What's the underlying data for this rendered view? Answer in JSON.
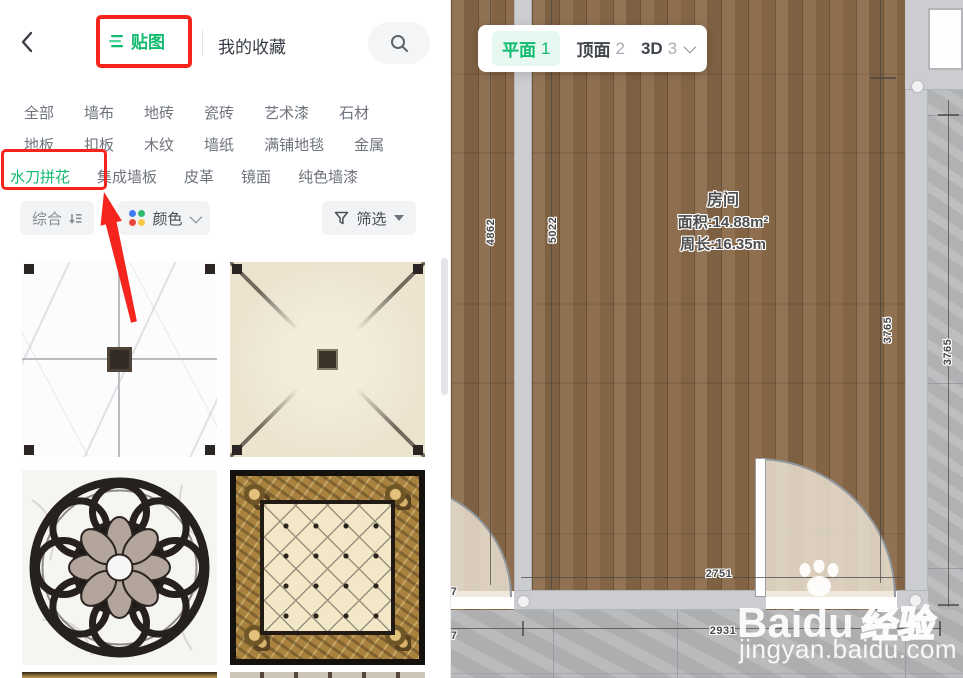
{
  "sidebar": {
    "tabs": {
      "textures": "贴图",
      "favorites": "我的收藏"
    },
    "categories_row1": [
      "全部",
      "墙布",
      "地砖",
      "瓷砖",
      "艺术漆",
      "石材"
    ],
    "categories_row2": [
      "地板",
      "扣板",
      "木纹",
      "墙纸",
      "满铺地毯",
      "金属"
    ],
    "categories_row3": [
      "水刀拼花",
      "集成墙板",
      "皮革",
      "镜面",
      "纯色墙漆"
    ],
    "active_category": "水刀拼花",
    "toolbar": {
      "sort_label": "综合",
      "color_label": "颜色",
      "filter_label": "筛选"
    },
    "thumbnails": [
      {
        "name": "white-marble-cross-tile"
      },
      {
        "name": "beige-marble-diagonal-tile"
      },
      {
        "name": "black-ring-medallion-tile"
      },
      {
        "name": "gold-border-lattice-tile"
      }
    ],
    "colors": {
      "accent_green": "#10ba6e",
      "annotation_red": "#f5241c",
      "color_dots": [
        "#3f7bf8",
        "#2dbd6e",
        "#e8483f",
        "#f5c943"
      ]
    }
  },
  "canvas": {
    "view_tabs": [
      {
        "label": "平面",
        "num": "1"
      },
      {
        "label": "顶面",
        "num": "2"
      },
      {
        "label": "3D",
        "num": "3"
      }
    ],
    "room": {
      "name": "房间",
      "area": "面积:14.88m²",
      "perimeter": "周长:16.35m"
    },
    "dimensions": {
      "v1": "4862",
      "v2": "5022",
      "v3": "3765",
      "v4": "3765",
      "h1": "2751",
      "h2": "2931",
      "edge1": "7",
      "edge2": "7"
    },
    "watermark": {
      "brand_latin": "Baidu",
      "brand_cn": "经验",
      "url": "jingyan.baidu.com"
    }
  }
}
